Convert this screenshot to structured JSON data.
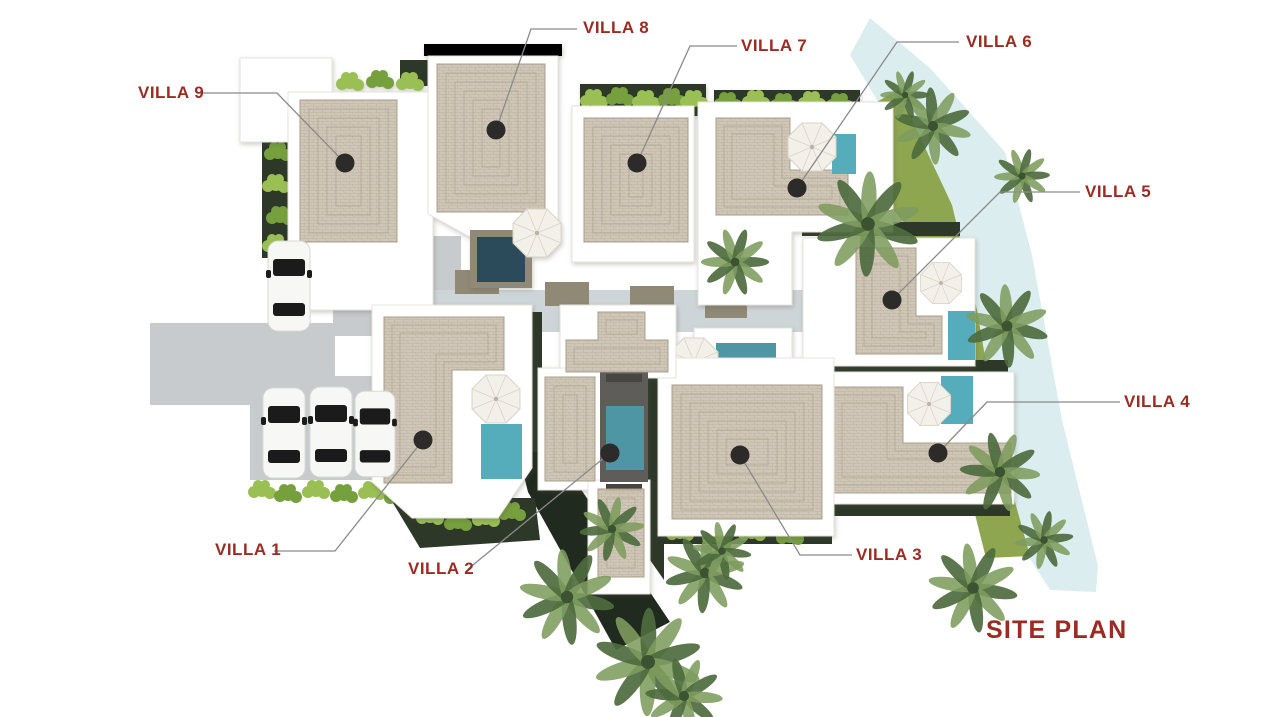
{
  "title": {
    "text": "SITE PLAN"
  },
  "villas": [
    {
      "id": 1,
      "label": "VILLA 1"
    },
    {
      "id": 2,
      "label": "VILLA 2"
    },
    {
      "id": 3,
      "label": "VILLA 3"
    },
    {
      "id": 4,
      "label": "VILLA 4"
    },
    {
      "id": 5,
      "label": "VILLA 5"
    },
    {
      "id": 6,
      "label": "VILLA 6"
    },
    {
      "id": 7,
      "label": "VILLA 7"
    },
    {
      "id": 8,
      "label": "VILLA 8"
    },
    {
      "id": 9,
      "label": "VILLA 9"
    }
  ],
  "colors": {
    "label": "#9C2B22",
    "leader": "#8A8A8A",
    "marker": "#2D2B29",
    "building": "#FFFFFF",
    "building_edge": "#E6E3DD",
    "roof": "#CFC5B5",
    "roof_line": "#A69A85",
    "pool": "#55ACBA",
    "pool_mid": "#4E96A4",
    "pool_dark": "#2B4A5A",
    "deck": "#5E5D59",
    "water": "#DCEDF0",
    "grass": "#8FA650",
    "hedge": "#2D3828",
    "wedge": "#202A1E",
    "bush": "#76A03E",
    "bush_light": "#9ABF55",
    "pavement": "#C7CBCE",
    "walkway": "#CED5D8",
    "stone": "#8F8976",
    "car": "#F7F7F5",
    "car_glass": "#1B1B1B",
    "umbrella": "#F3F0E9",
    "umbrella_line": "#D9D4C8",
    "palm_dark": "#4E6B3E",
    "palm_light": "#7E9C5F"
  }
}
